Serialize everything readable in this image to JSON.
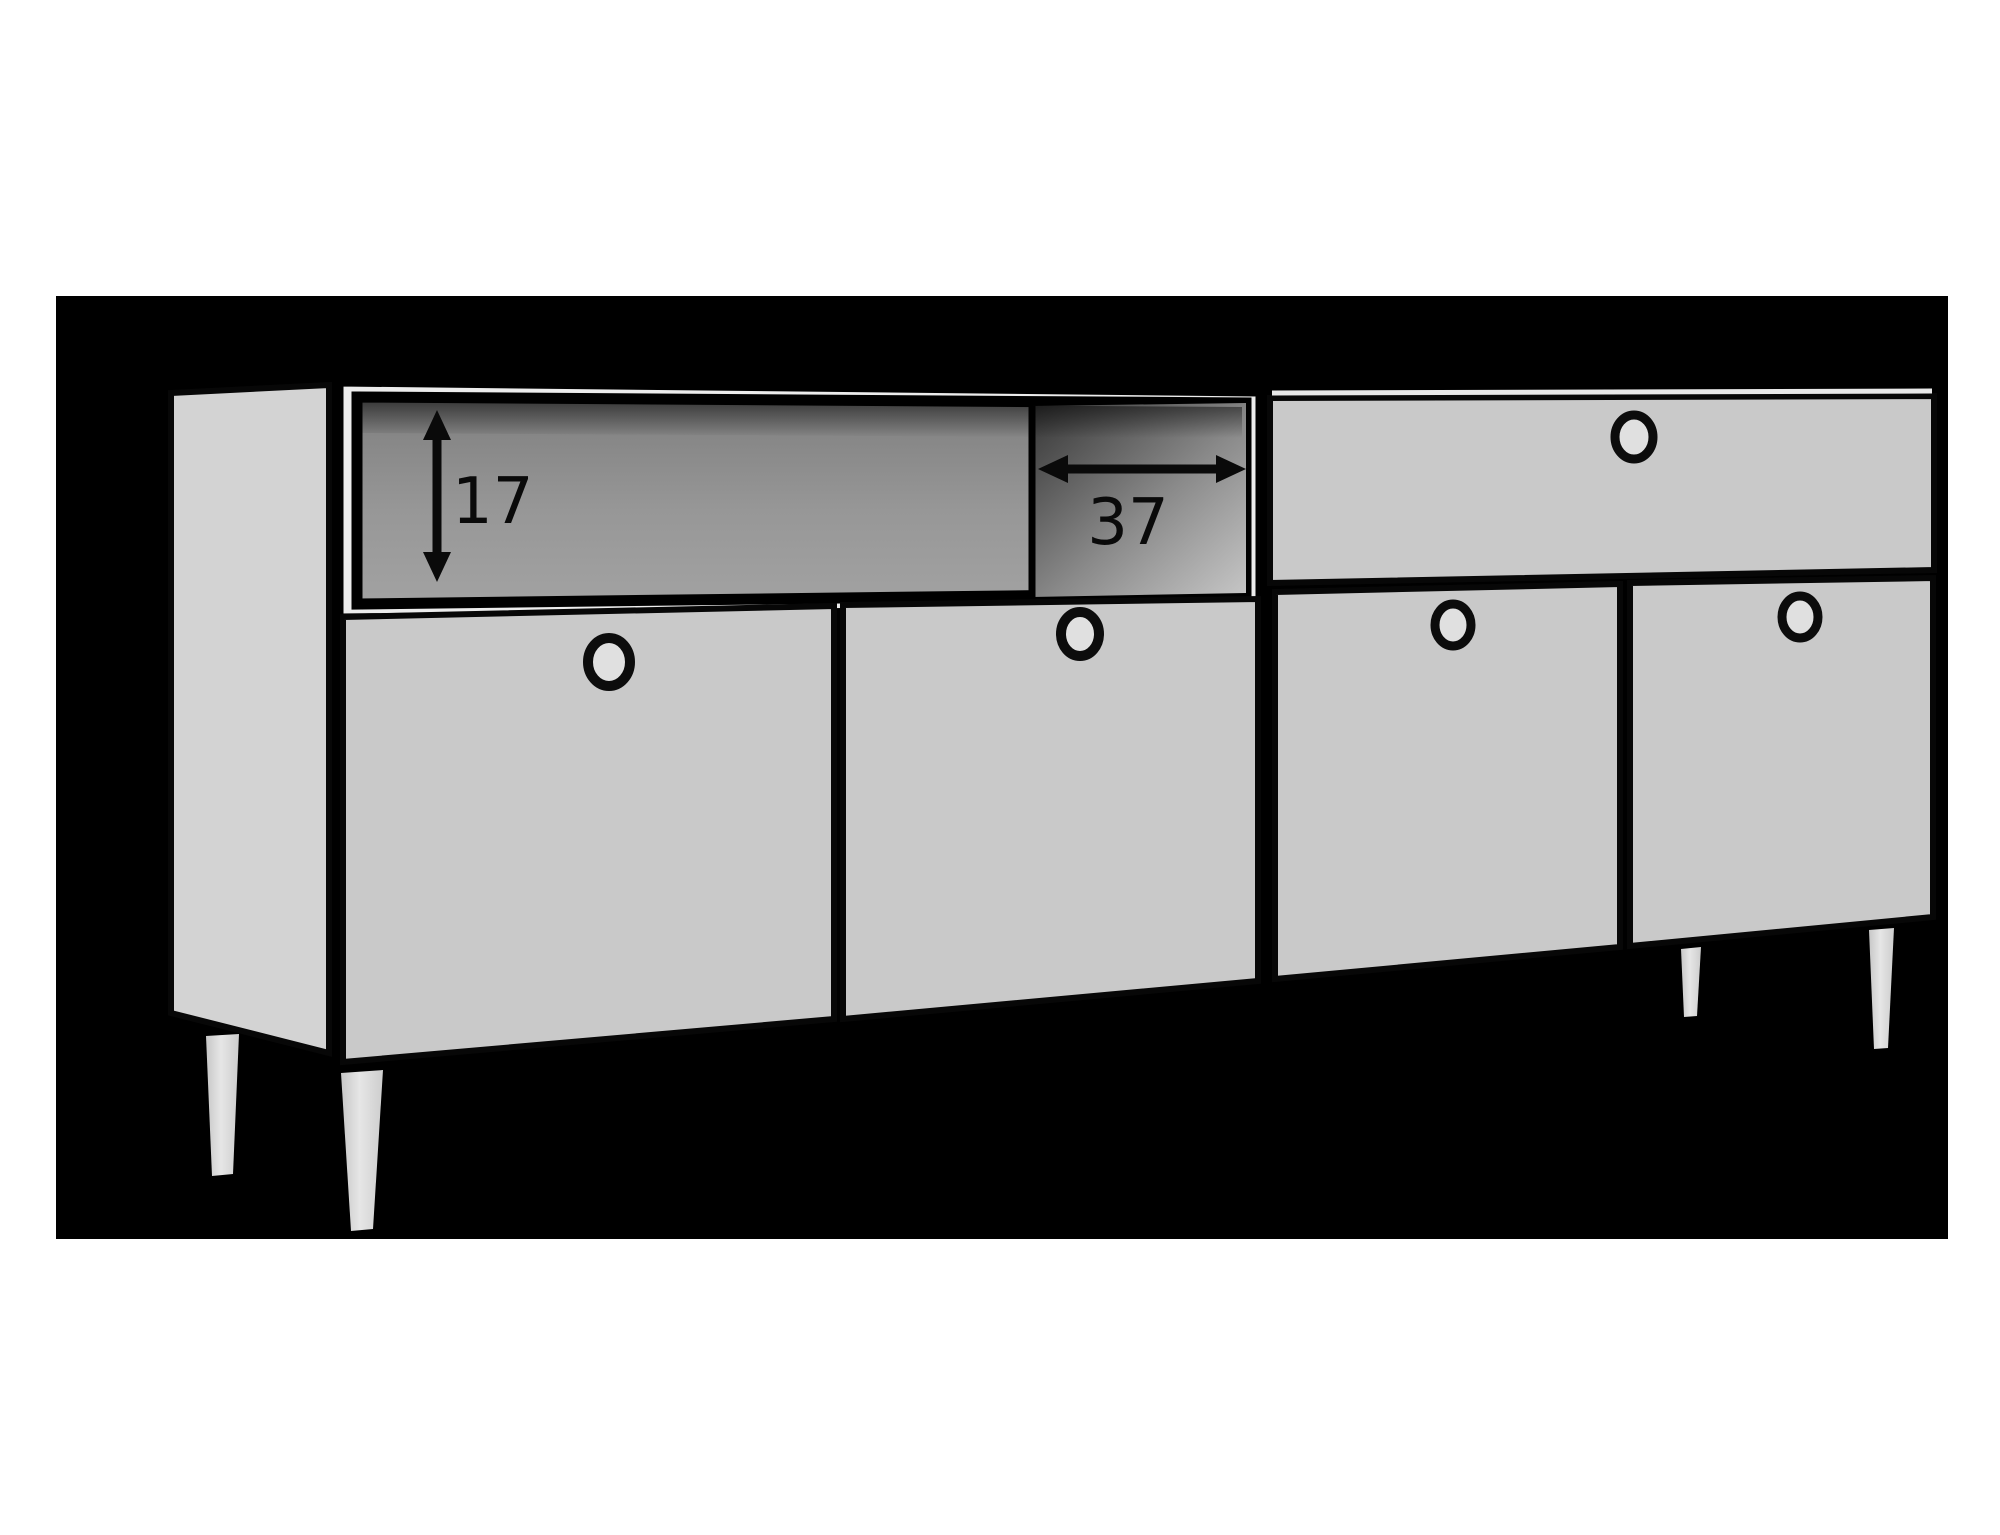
{
  "scene": {
    "background_color": "#ffffff",
    "panel_color": "#000000",
    "cabinet_color": "#c9c9c9",
    "ink_color": "#0a0a0a",
    "shelf_interior_color": "#959595"
  },
  "annotations": {
    "shelf_height": {
      "label": "17",
      "orientation": "vertical"
    },
    "shelf_width": {
      "label": "37",
      "orientation": "horizontal"
    }
  },
  "furniture": {
    "open_shelves": 1,
    "drawers": 1,
    "doors": 4,
    "knobs": 5,
    "legs": 4
  }
}
